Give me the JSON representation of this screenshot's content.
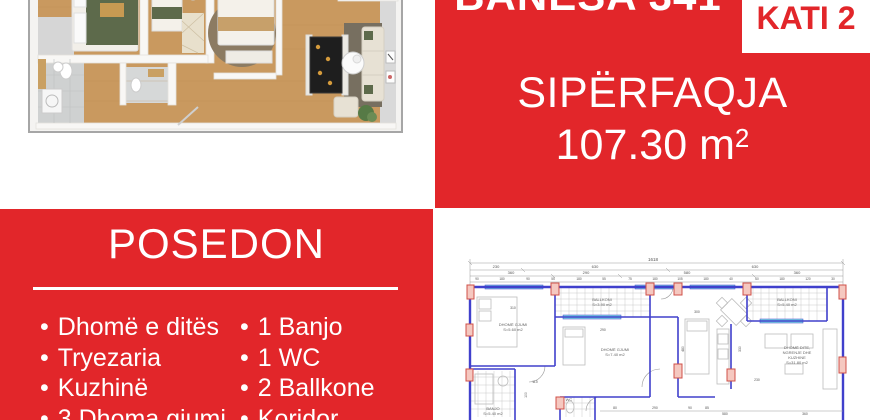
{
  "colors": {
    "accent_red": "#E2262A",
    "wall_blue": "#4040CC",
    "column_red": "#D05048",
    "window_cyan": "#7EDCE2"
  },
  "top_right": {
    "title": "BANESA 341",
    "floor_badge": "KATI 2",
    "area_label": "SIPËRFAQJA",
    "area_value": "107.30 m",
    "area_sup": "2"
  },
  "posedon": {
    "title": "POSEDON",
    "bullet": "•",
    "left_items": [
      "Dhomë e ditës",
      "Tryezaria",
      "Kuzhinë",
      "3 Dhoma gjumi"
    ],
    "right_items": [
      "1 Banjo",
      "1 WC",
      "2 Ballkone",
      "Koridor"
    ]
  },
  "tech_plan": {
    "dim_total": "1618",
    "dim_row2": [
      "230",
      "630",
      "630"
    ],
    "dim_row3": [
      "360",
      "290",
      "580",
      "360"
    ],
    "dim_row4": [
      "90",
      "180",
      "90",
      "55",
      "180",
      "55",
      "75",
      "180",
      "105",
      "180",
      "40",
      "60",
      "180",
      "120",
      "30"
    ],
    "rooms": {
      "bedroom1": [
        "DHOMË GJUMI",
        "S=5.60 m2"
      ],
      "balcony1": [
        "BALLKONI",
        "S=3.90 m2"
      ],
      "bedroom2": [
        "DHOMË GJUMI",
        "S=7.40 m2"
      ],
      "banjo": [
        "BANJO",
        "S=5.40 m2"
      ],
      "wc": [
        "WC"
      ],
      "living": [
        "DHOMË DITE,",
        "NGRENJE DHE",
        "KUZHINE",
        "S=31.80 m2"
      ],
      "balcony2": [
        "BALLKONI",
        "S=5.40 m2"
      ]
    },
    "inline_dims": {
      "d310": "310",
      "d290": "290",
      "d300": "300",
      "d480": "480",
      "d110": "110",
      "d230": "230",
      "d580": "580",
      "d330": "330",
      "d360": "360",
      "d100": "100",
      "d80": "80",
      "d290b": "290",
      "d90": "90",
      "d85": "85"
    }
  }
}
